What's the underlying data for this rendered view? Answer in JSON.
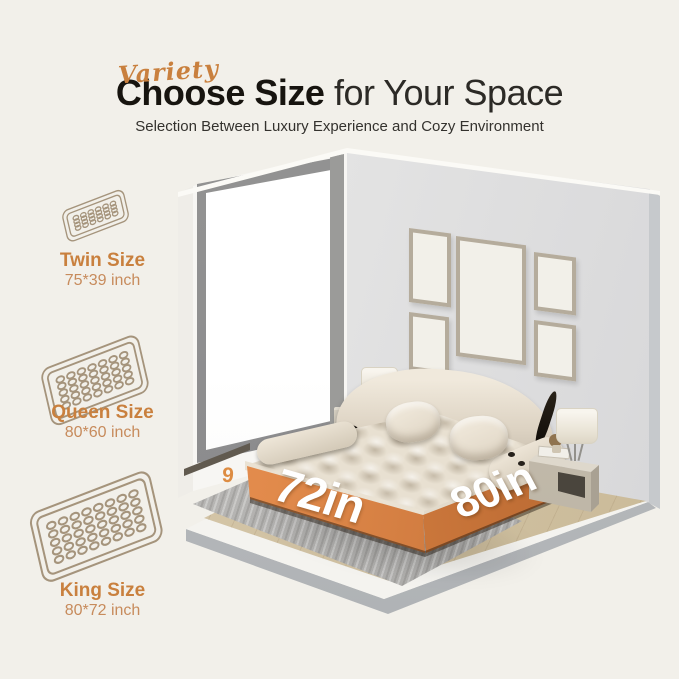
{
  "header": {
    "script_word": "Variety",
    "title_strong": "Choose Size",
    "title_light": " for Your Space",
    "subtitle": "Selection Between Luxury Experience and Cozy Environment"
  },
  "size_options": [
    {
      "label": "Twin Size",
      "dims": "75*39 inch",
      "icon": "twin-mattress-icon",
      "coil_cols": 6,
      "coil_rows": 4,
      "pad_w": 96,
      "pad_h": 46
    },
    {
      "label": "Queen Size",
      "dims": "80*60 inch",
      "icon": "queen-mattress-icon",
      "coil_cols": 7,
      "coil_rows": 5,
      "pad_w": 112,
      "pad_h": 62
    },
    {
      "label": "King Size",
      "dims": "80*72 inch",
      "icon": "king-mattress-icon",
      "coil_cols": 8,
      "coil_rows": 5,
      "pad_w": 124,
      "pad_h": 68
    }
  ],
  "scene": {
    "width_label": "72in",
    "depth_label": "80in",
    "height_digit": "9"
  },
  "colors": {
    "background": "#f2f0ea",
    "accent_text": "#c9803e",
    "accent_light": "#c78b5c",
    "band_orange_light": "#f29c5c",
    "band_orange_dark": "#b8662f",
    "title_black": "#17140f",
    "label_white": "#ffffff"
  }
}
